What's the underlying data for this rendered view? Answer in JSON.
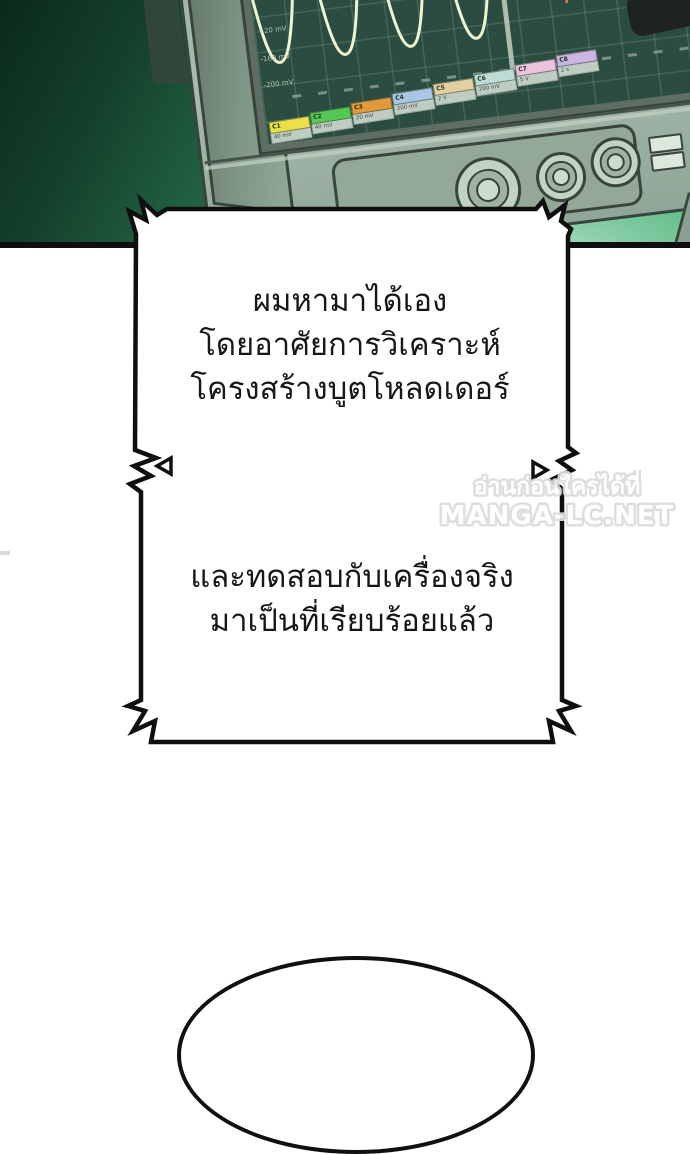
{
  "scene": {
    "oscilloscope": {
      "axis_labels": [
        "-40 mV",
        "-80 mV",
        "-120 mV",
        "-160 mV",
        "-200 mV"
      ],
      "channels": [
        {
          "id": "C1",
          "color": "#e9e04a",
          "value": "40 mV"
        },
        {
          "id": "C2",
          "color": "#55c853",
          "value": "40 mV"
        },
        {
          "id": "C3",
          "color": "#e2993b",
          "value": "20 mV"
        },
        {
          "id": "C4",
          "color": "#a9c6e4",
          "value": "200 mV"
        },
        {
          "id": "C5",
          "color": "#e4cfa2",
          "value": "2 V"
        },
        {
          "id": "C6",
          "color": "#bedcd6",
          "value": "200 mV"
        },
        {
          "id": "C7",
          "color": "#eac4dd",
          "value": "5 V"
        },
        {
          "id": "C8",
          "color": "#ccb4e4",
          "value": "2 s"
        }
      ],
      "waveform_colors": {
        "sine": "#eef3d0",
        "burst": "#d9822e",
        "pulse": "#e8ece0",
        "screen": "#2b4c41"
      }
    }
  },
  "bubble1": {
    "lines": [
      "ผมหามาได้เอง",
      "โดยอาศัยการวิเคราะห์",
      "โครงสร้างบูตโหลดเดอร์"
    ]
  },
  "bubble2": {
    "lines": [
      "และทดสอบกับเครื่องจริง",
      "มาเป็นที่เรียบร้อยแล้ว"
    ]
  },
  "watermark": {
    "line1": "อ่านก่อนใครได้ที่",
    "line2": "MANGA-LC.NET"
  }
}
